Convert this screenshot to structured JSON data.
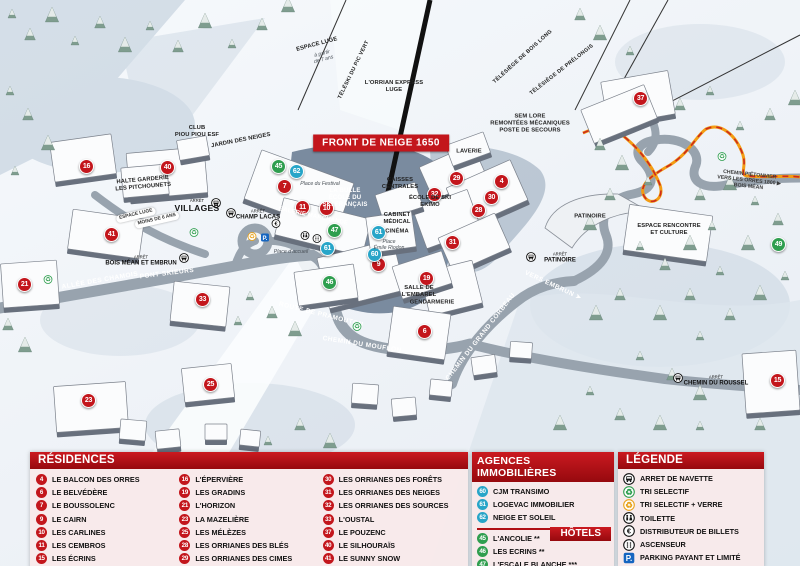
{
  "title_banner": "FRONT DE NEIGE 1650",
  "colors": {
    "residence": "#c3161c",
    "hotel": "#2f9e4f",
    "agency": "#27a5c8",
    "panel_red": "#b01015"
  },
  "map": {
    "markers": [
      {
        "n": "16",
        "x": 86,
        "y": 166,
        "t": "residence"
      },
      {
        "n": "40",
        "x": 167,
        "y": 167,
        "t": "residence"
      },
      {
        "n": "41",
        "x": 111,
        "y": 234,
        "t": "residence"
      },
      {
        "n": "21",
        "x": 24,
        "y": 284,
        "t": "residence"
      },
      {
        "n": "33",
        "x": 202,
        "y": 299,
        "t": "residence"
      },
      {
        "n": "23",
        "x": 88,
        "y": 400,
        "t": "residence"
      },
      {
        "n": "25",
        "x": 210,
        "y": 384,
        "t": "residence"
      },
      {
        "n": "7",
        "x": 284,
        "y": 186,
        "t": "residence"
      },
      {
        "n": "11",
        "x": 302,
        "y": 207,
        "t": "residence"
      },
      {
        "n": "10",
        "x": 326,
        "y": 208,
        "t": "residence"
      },
      {
        "n": "9",
        "x": 378,
        "y": 264,
        "t": "residence"
      },
      {
        "n": "19",
        "x": 426,
        "y": 278,
        "t": "residence"
      },
      {
        "n": "6",
        "x": 424,
        "y": 331,
        "t": "residence"
      },
      {
        "n": "29",
        "x": 456,
        "y": 178,
        "t": "residence"
      },
      {
        "n": "4",
        "x": 501,
        "y": 181,
        "t": "residence"
      },
      {
        "n": "32",
        "x": 434,
        "y": 194,
        "t": "residence"
      },
      {
        "n": "30",
        "x": 491,
        "y": 197,
        "t": "residence"
      },
      {
        "n": "28",
        "x": 478,
        "y": 210,
        "t": "residence"
      },
      {
        "n": "31",
        "x": 452,
        "y": 242,
        "t": "residence"
      },
      {
        "n": "37",
        "x": 640,
        "y": 98,
        "t": "residence"
      },
      {
        "n": "15",
        "x": 777,
        "y": 380,
        "t": "residence"
      },
      {
        "n": "45",
        "x": 278,
        "y": 166,
        "t": "hotel"
      },
      {
        "n": "47",
        "x": 334,
        "y": 230,
        "t": "hotel"
      },
      {
        "n": "46",
        "x": 329,
        "y": 282,
        "t": "hotel"
      },
      {
        "n": "49",
        "x": 778,
        "y": 244,
        "t": "hotel"
      },
      {
        "n": "62",
        "x": 296,
        "y": 171,
        "t": "agency"
      },
      {
        "n": "61",
        "x": 327,
        "y": 248,
        "t": "agency"
      },
      {
        "n": "61",
        "x": 378,
        "y": 232,
        "t": "agency"
      },
      {
        "n": "60",
        "x": 374,
        "y": 254,
        "t": "agency"
      }
    ],
    "labels": [
      {
        "t": "ALLÉE DES CHAMOIS",
        "x": 100,
        "y": 281,
        "r": -10,
        "c": "road"
      },
      {
        "t": "PONT SKIEURS",
        "x": 167,
        "y": 274,
        "r": -7,
        "c": "road"
      },
      {
        "t": "ROUTE DE PRAMOUTON",
        "x": 321,
        "y": 315,
        "r": 14,
        "c": "road"
      },
      {
        "t": "CHEMIN DU MOUFLON",
        "x": 362,
        "y": 345,
        "r": 9,
        "c": "road"
      },
      {
        "t": "CHEMIN DU GRAND CORBEAU",
        "x": 481,
        "y": 337,
        "r": -52,
        "c": "road"
      },
      {
        "t": "VERS EMBRUN ➤",
        "x": 553,
        "y": 286,
        "r": 25,
        "c": "road"
      },
      {
        "t": "CLUB|PIOU PIOU ESF",
        "x": 197,
        "y": 132,
        "r": 0,
        "c": "dark"
      },
      {
        "t": "JARDIN DES NEIGES",
        "x": 241,
        "y": 141,
        "r": -11,
        "c": "dark"
      },
      {
        "t": "HALTE GARDERIE|LES PITCHOUNETS",
        "x": 143,
        "y": 184,
        "r": -5,
        "c": "dark"
      },
      {
        "t": "L'ORRIAN EXPRESS|LUGE",
        "x": 394,
        "y": 87,
        "r": 0,
        "c": "dark"
      },
      {
        "t": "SEM LORE|REMONTÉES MÉCANIQUES|POSTE DE SECOURS",
        "x": 530,
        "y": 124,
        "r": 0,
        "c": "dark"
      },
      {
        "t": "LAVERIE",
        "x": 469,
        "y": 152,
        "r": 0,
        "c": "dark"
      },
      {
        "t": "CAISSES|CENTRALES",
        "x": 400,
        "y": 184,
        "r": 0,
        "c": "dark"
      },
      {
        "t": "CABINET|MÉDICAL",
        "x": 397,
        "y": 219,
        "r": 0,
        "c": "dark"
      },
      {
        "t": "CINÉMA",
        "x": 397,
        "y": 232,
        "r": 0,
        "c": "dark"
      },
      {
        "t": "GENDARMERIE",
        "x": 432,
        "y": 303,
        "r": 0,
        "c": "dark"
      },
      {
        "t": "SALLE DE|L'EMBAREL",
        "x": 419,
        "y": 292,
        "r": 0,
        "c": "dark"
      },
      {
        "t": "ÉCOLE DE SKI|EKIMO",
        "x": 430,
        "y": 202,
        "r": 0,
        "c": "dark"
      },
      {
        "t": "PATINOIRE",
        "x": 590,
        "y": 217,
        "r": 0,
        "c": "dark"
      },
      {
        "t": "ESPACE RENCONTRE|ET CULTURE",
        "x": 669,
        "y": 230,
        "r": 0,
        "c": "dark"
      },
      {
        "t": "ESPACE LUGE",
        "x": 317,
        "y": 45,
        "r": -15,
        "c": "dark"
      },
      {
        "t": "à partir|de 7 ans",
        "x": 323,
        "y": 57,
        "r": -15,
        "c": "place"
      },
      {
        "t": "LA BULLE|ÉCOLE DU|SKI FRANÇAIS",
        "x": 345,
        "y": 199,
        "r": 0,
        "c": "wlab"
      },
      {
        "t": "GALERIE MARCHANDE",
        "x": 313,
        "y": 217,
        "r": 12,
        "c": "wlab"
      },
      {
        "t": "Place du Festival",
        "x": 320,
        "y": 184,
        "r": 0,
        "c": "place"
      },
      {
        "t": "Place d'accueil",
        "x": 291,
        "y": 252,
        "r": 0,
        "c": "place"
      },
      {
        "t": "Place|Émile Riodon",
        "x": 389,
        "y": 245,
        "r": 0,
        "c": "place"
      },
      {
        "t": "TÉLÉSKI DU PIC VERT",
        "x": 354,
        "y": 70,
        "r": -64,
        "c": "lift"
      },
      {
        "t": "TÉLÉSIÈGE DE BOIS LONG",
        "x": 523,
        "y": 57,
        "r": -42,
        "c": "lift"
      },
      {
        "t": "TÉLÉSIÈGE DE PRÉLONGIS",
        "x": 562,
        "y": 70,
        "r": -38,
        "c": "lift"
      },
      {
        "t": "CHEMIN PIÉTONNIER|VERS LES ORRES 1800 ▶|BOIS MÉAN",
        "x": 749,
        "y": 181,
        "r": 6,
        "c": "trail"
      },
      {
        "t": "ESPACE LUGE",
        "x": 136,
        "y": 215,
        "r": -13,
        "c": "pill"
      },
      {
        "t": "MOINS DE 6 ANS",
        "x": 157,
        "y": 220,
        "r": -13,
        "c": "pill"
      }
    ],
    "bus_stops": [
      {
        "t": "VILLAGES",
        "arret": "ARRÊT",
        "x": 197,
        "y": 206,
        "ix": 216,
        "iy": 204,
        "big": true
      },
      {
        "t": "CHAMP LACAS",
        "arret": "ARRÊT",
        "x": 258,
        "y": 215,
        "ix": 231,
        "iy": 214,
        "big": false
      },
      {
        "t": "BOIS MÉAN ET EMBRUN",
        "arret": "ARRÊT",
        "x": 141,
        "y": 261,
        "ix": 184,
        "iy": 259,
        "big": false
      },
      {
        "t": "PATINOIRE",
        "arret": "ARRÊT",
        "x": 560,
        "y": 258,
        "ix": 531,
        "iy": 258,
        "big": false
      },
      {
        "t": "CHEMIN DU ROUSSEL",
        "arret": "ARRÊT",
        "x": 716,
        "y": 381,
        "ix": 678,
        "iy": 379,
        "big": false
      }
    ],
    "poi_icons": [
      {
        "type": "euro-icon",
        "x": 276,
        "y": 224
      },
      {
        "type": "toilet-icon",
        "x": 305,
        "y": 236
      },
      {
        "type": "elevator-icon",
        "x": 317,
        "y": 239
      },
      {
        "type": "recycle-green-icon",
        "x": 194,
        "y": 233
      },
      {
        "type": "recycle-green-icon",
        "x": 48,
        "y": 280
      },
      {
        "type": "recycle-green-icon",
        "x": 357,
        "y": 327
      },
      {
        "type": "recycle-green-icon",
        "x": 722,
        "y": 157
      },
      {
        "type": "recycle-yellow-icon",
        "x": 252,
        "y": 237
      },
      {
        "type": "parking-icon",
        "x": 265,
        "y": 238
      }
    ]
  },
  "panels": {
    "residences": {
      "title": "RÉSIDENCES",
      "items": [
        {
          "n": "4",
          "t": "LE BALCON DES ORRES"
        },
        {
          "n": "6",
          "t": "LE BELVÉDÈRE"
        },
        {
          "n": "7",
          "t": "LE BOUSSOLENC"
        },
        {
          "n": "9",
          "t": "LE CAIRN"
        },
        {
          "n": "10",
          "t": "LES CARLINES"
        },
        {
          "n": "11",
          "t": "LES CEMBROS"
        },
        {
          "n": "15",
          "t": "LES ÉCRINS"
        },
        {
          "n": "16",
          "t": "L'ÉPERVIÈRE"
        },
        {
          "n": "19",
          "t": "LES GRADINS"
        },
        {
          "n": "21",
          "t": "L'HORIZON"
        },
        {
          "n": "23",
          "t": "LA MAZELIÈRE"
        },
        {
          "n": "25",
          "t": "LES MÉLÈZES"
        },
        {
          "n": "28",
          "t": "LES ORRIANES DES BLÉS"
        },
        {
          "n": "29",
          "t": "LES ORRIANES DES CIMES"
        },
        {
          "n": "30",
          "t": "LES ORRIANES DES FORÊTS"
        },
        {
          "n": "31",
          "t": "LES ORRIANES DES NEIGES"
        },
        {
          "n": "32",
          "t": "LES ORRIANES DES SOURCES"
        },
        {
          "n": "33",
          "t": "L'OUSTAL"
        },
        {
          "n": "37",
          "t": "LE POUZENC"
        },
        {
          "n": "40",
          "t": "LE SILHOURAÏS"
        },
        {
          "n": "41",
          "t": "LE SUNNY SNOW"
        }
      ]
    },
    "agences": {
      "title": "AGENCES IMMOBILIÈRES",
      "items": [
        {
          "n": "60",
          "t": "CJM TRANSIMO"
        },
        {
          "n": "61",
          "t": "LOGEVAC IMMOBILIER"
        },
        {
          "n": "62",
          "t": "NEIGE ET SOLEIL"
        }
      ]
    },
    "hotels": {
      "title": "HÔTELS",
      "items": [
        {
          "n": "45",
          "t": "L'ANCOLIE **"
        },
        {
          "n": "46",
          "t": "LES ECRINS **"
        },
        {
          "n": "47",
          "t": "L'ESCALE BLANCHE ***"
        },
        {
          "n": "49",
          "t": "LES TRAPPEURS **"
        }
      ]
    },
    "legende": {
      "title": "LÉGENDE",
      "items": [
        {
          "icon": "bus-icon",
          "t": "ARRET DE NAVETTE"
        },
        {
          "icon": "recycle-green-icon",
          "t": "TRI SELECTIF"
        },
        {
          "icon": "recycle-yellow-icon",
          "t": "TRI SELECTIF + VERRE"
        },
        {
          "icon": "toilet-icon",
          "t": "TOILETTE"
        },
        {
          "icon": "euro-icon",
          "t": "DISTRIBUTEUR DE BILLETS"
        },
        {
          "icon": "elevator-icon",
          "t": "ASCENSEUR"
        },
        {
          "icon": "parking-icon",
          "t": "PARKING PAYANT ET LIMITÉ"
        }
      ]
    }
  }
}
